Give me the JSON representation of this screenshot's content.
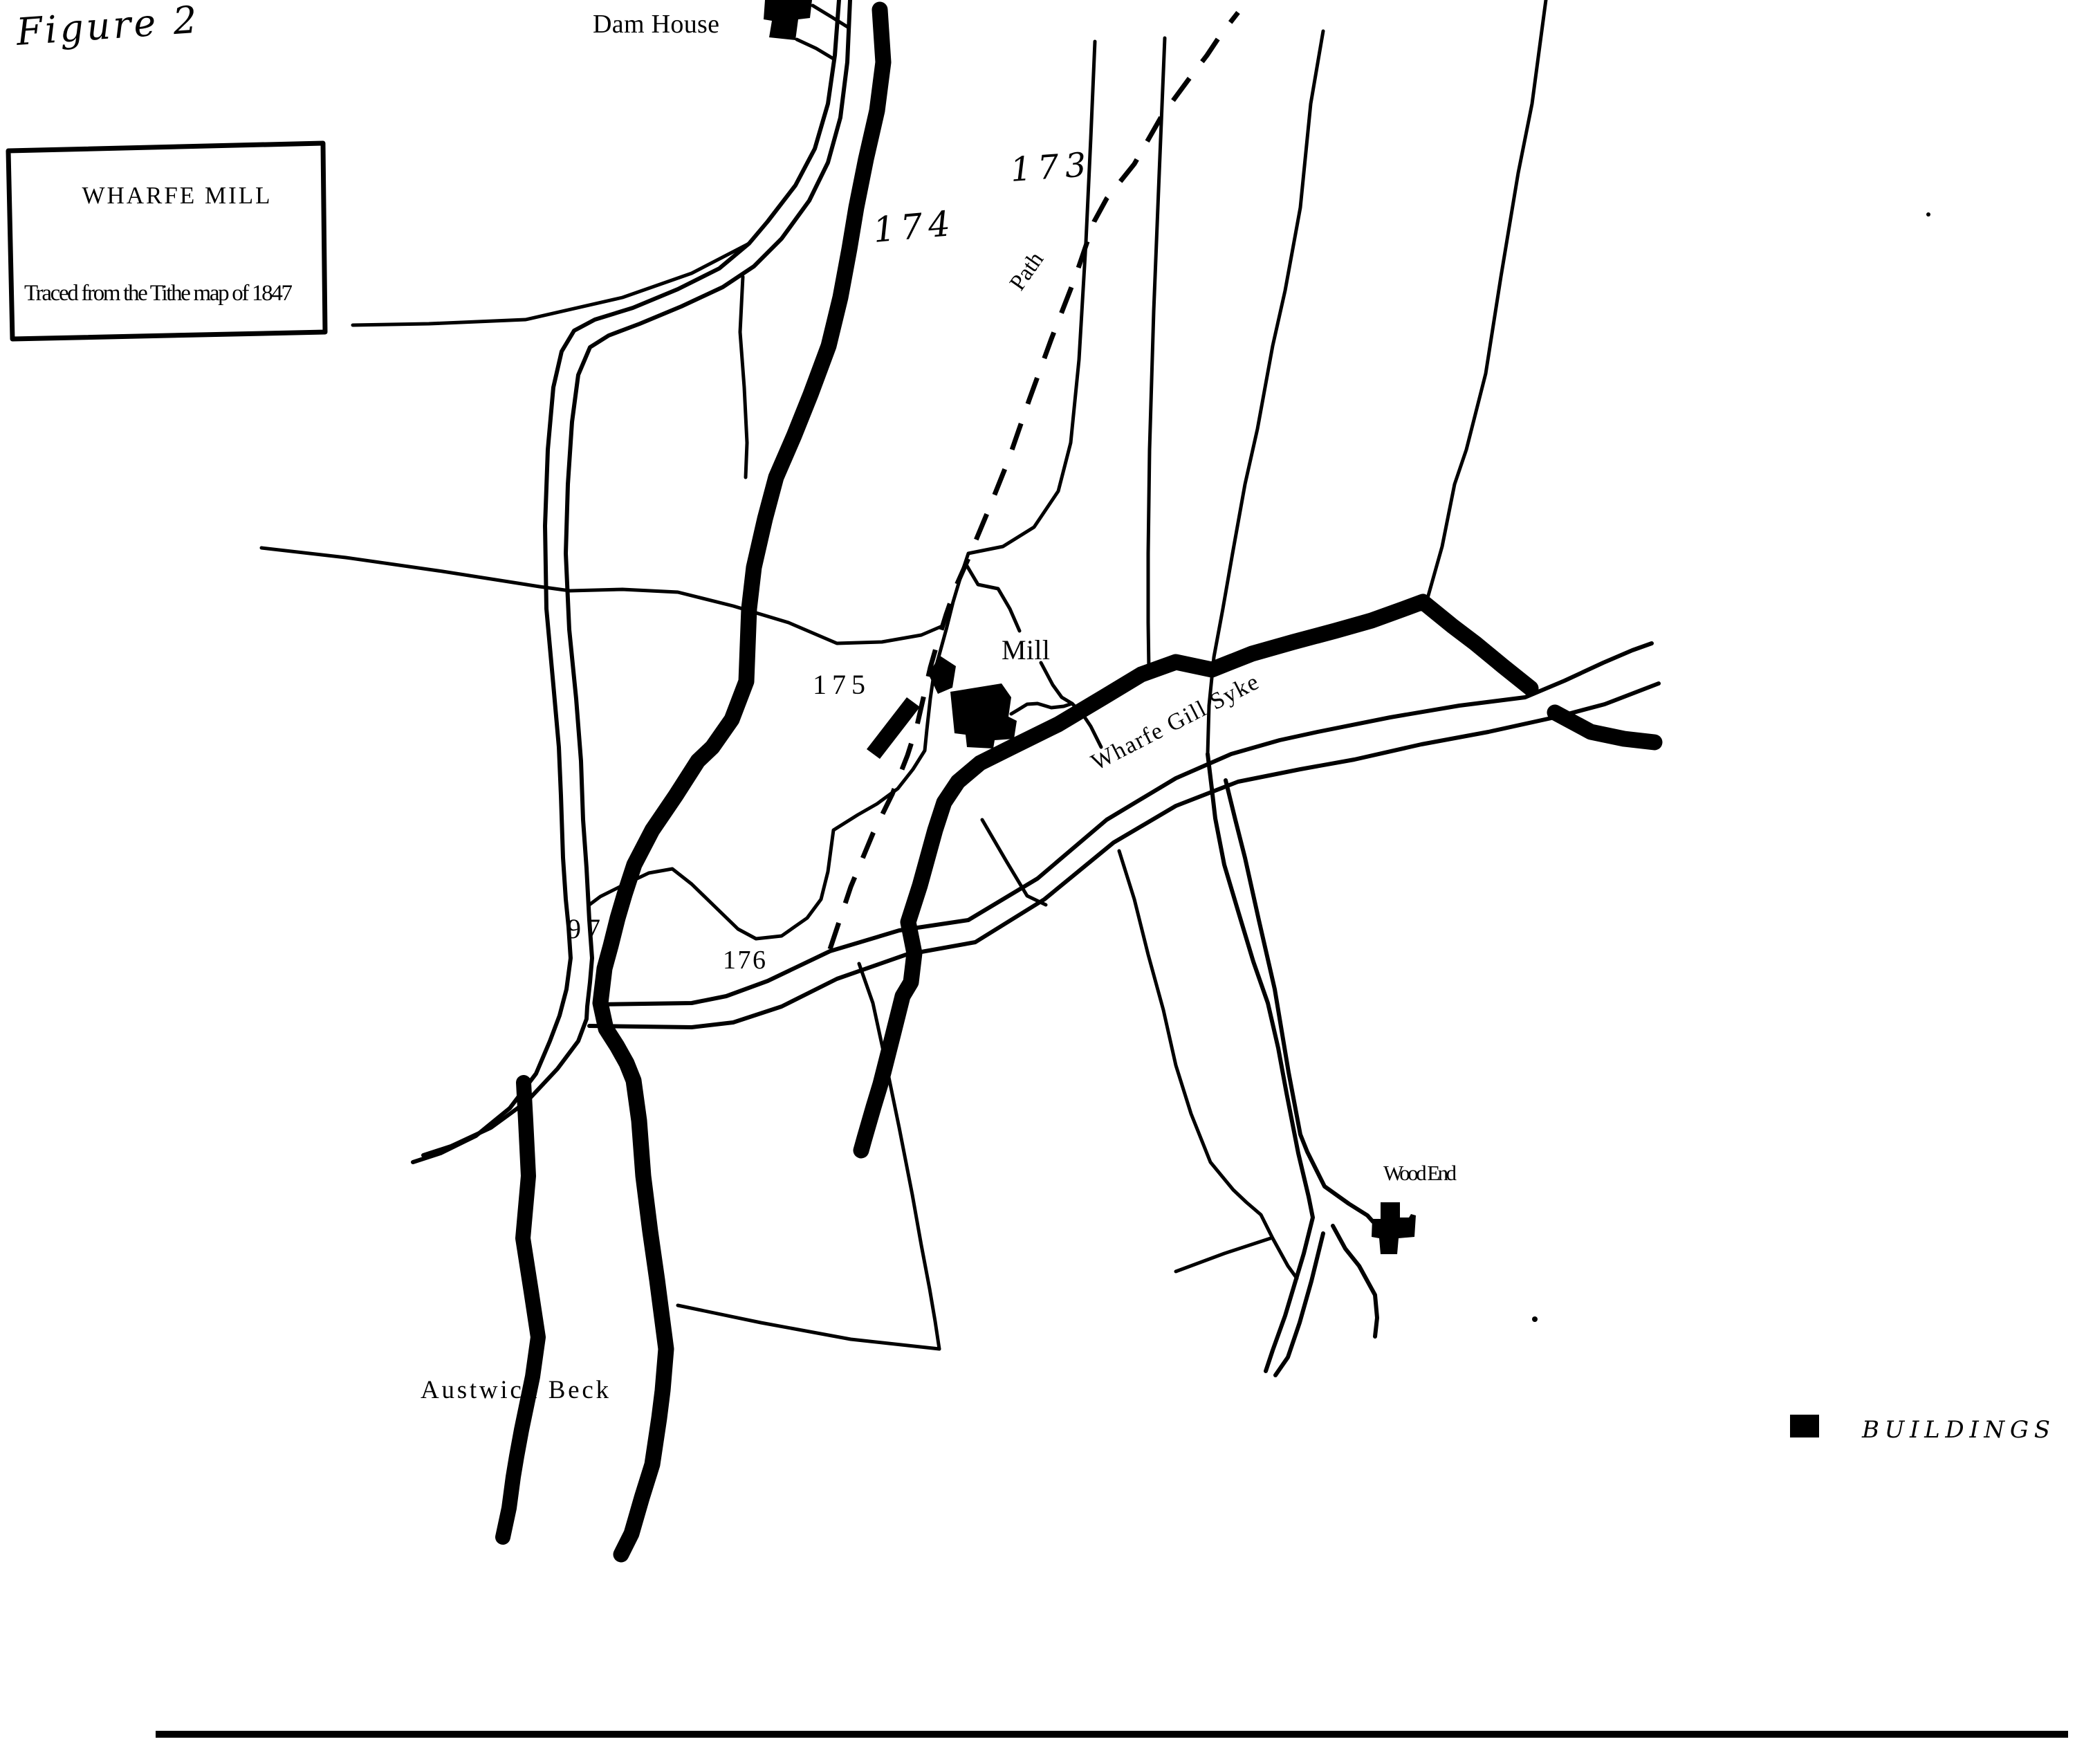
{
  "figure_label": "Figure 2",
  "title_box": {
    "title": "WHARFE MILL",
    "subtitle": "Traced from the Tithe map of 1847"
  },
  "labels": {
    "dam_house": "Dam House",
    "field_174": "174",
    "field_173": "173",
    "path": "Path",
    "mill": "Mill",
    "field_175": "175",
    "wharfe_gill_syke": "Wharfe Gill Syke",
    "field_97": "97",
    "field_176": "176",
    "austwick_beck": "Austwick Beck",
    "wood_end": "Wood End"
  },
  "legend": {
    "symbol": "building-square",
    "label": "BUILDINGS"
  },
  "colors": {
    "ink": "#000000",
    "paper": "#ffffff"
  }
}
